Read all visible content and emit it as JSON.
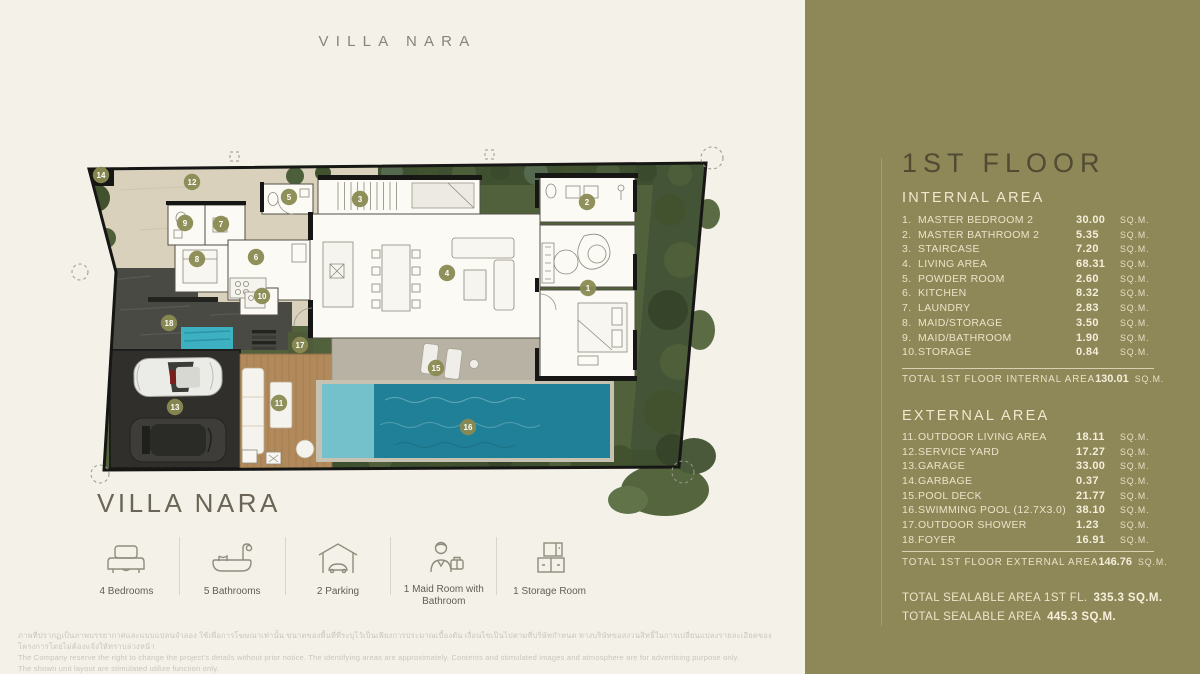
{
  "page": {
    "background": "#f4f1e8",
    "top_title": "VILLA NARA",
    "plan_title": "VILLA NARA"
  },
  "sidebar": {
    "background": "#8e8758",
    "floor_title": "1ST FLOOR",
    "internal": {
      "heading": "INTERNAL AREA",
      "rows": [
        {
          "num": "1.",
          "label": "MASTER BEDROOM 2",
          "value": "30.00",
          "unit": "SQ.M."
        },
        {
          "num": "2.",
          "label": "MASTER BATHROOM 2",
          "value": "5.35",
          "unit": "SQ.M."
        },
        {
          "num": "3.",
          "label": "STAIRCASE",
          "value": "7.20",
          "unit": "SQ.M."
        },
        {
          "num": "4.",
          "label": "LIVING AREA",
          "value": "68.31",
          "unit": "SQ.M."
        },
        {
          "num": "5.",
          "label": "POWDER ROOM",
          "value": "2.60",
          "unit": "SQ.M."
        },
        {
          "num": "6.",
          "label": "KITCHEN",
          "value": "8.32",
          "unit": "SQ.M."
        },
        {
          "num": "7.",
          "label": "LAUNDRY",
          "value": "2.83",
          "unit": "SQ.M."
        },
        {
          "num": "8.",
          "label": "MAID/STORAGE",
          "value": "3.50",
          "unit": "SQ.M."
        },
        {
          "num": "9.",
          "label": "MAID/BATHROOM",
          "value": "1.90",
          "unit": "SQ.M."
        },
        {
          "num": "10.",
          "label": "STORAGE",
          "value": "0.84",
          "unit": "SQ.M."
        }
      ],
      "total_label": "TOTAL 1ST FLOOR INTERNAL AREA",
      "total_value": "130.01",
      "total_unit": "SQ.M."
    },
    "external": {
      "heading": "EXTERNAL AREA",
      "rows": [
        {
          "num": "11.",
          "label": "OUTDOOR LIVING AREA",
          "value": "18.11",
          "unit": "SQ.M."
        },
        {
          "num": "12.",
          "label": "SERVICE YARD",
          "value": "17.27",
          "unit": "SQ.M."
        },
        {
          "num": "13.",
          "label": "GARAGE",
          "value": "33.00",
          "unit": "SQ.M."
        },
        {
          "num": "14.",
          "label": "GARBAGE",
          "value": "0.37",
          "unit": "SQ.M."
        },
        {
          "num": "15.",
          "label": "POOL DECK",
          "value": "21.77",
          "unit": "SQ.M."
        },
        {
          "num": "16.",
          "label": "SWIMMING POOL (12.7X3.0)",
          "value": "38.10",
          "unit": "SQ.M."
        },
        {
          "num": "17.",
          "label": "OUTDOOR SHOWER",
          "value": "1.23",
          "unit": "SQ.M."
        },
        {
          "num": "18.",
          "label": "FOYER",
          "value": "16.91",
          "unit": "SQ.M."
        }
      ],
      "total_label": "TOTAL 1ST FLOOR EXTERNAL AREA",
      "total_value": "146.76",
      "total_unit": "SQ.M."
    },
    "sealable": [
      {
        "label": "TOTAL SEALABLE AREA 1ST FL.",
        "value": "335.3 SQ.M."
      },
      {
        "label": "TOTAL SEALABLE AREA",
        "value": "445.3 SQ.M."
      }
    ]
  },
  "features": [
    {
      "icon": "bed-icon",
      "label": "4 Bedrooms"
    },
    {
      "icon": "bath-icon",
      "label": "5 Bathrooms"
    },
    {
      "icon": "parking-icon",
      "label": "2 Parking"
    },
    {
      "icon": "maid-icon",
      "label": "1 Maid Room with Bathroom"
    },
    {
      "icon": "storage-icon",
      "label": "1 Storage Room"
    }
  ],
  "plan": {
    "marker_color": "#8a8a52",
    "marker_text_color": "#ffffff",
    "pool_color": "#208097",
    "markers": [
      {
        "n": "1",
        "x": 508,
        "y": 138
      },
      {
        "n": "2",
        "x": 507,
        "y": 52
      },
      {
        "n": "3",
        "x": 280,
        "y": 49
      },
      {
        "n": "4",
        "x": 367,
        "y": 123
      },
      {
        "n": "5",
        "x": 209,
        "y": 47
      },
      {
        "n": "6",
        "x": 176,
        "y": 107
      },
      {
        "n": "7",
        "x": 141,
        "y": 74
      },
      {
        "n": "8",
        "x": 117,
        "y": 109
      },
      {
        "n": "9",
        "x": 105,
        "y": 73
      },
      {
        "n": "10",
        "x": 182,
        "y": 146
      },
      {
        "n": "11",
        "x": 199,
        "y": 253
      },
      {
        "n": "12",
        "x": 112,
        "y": 32
      },
      {
        "n": "13",
        "x": 95,
        "y": 257
      },
      {
        "n": "14",
        "x": 21,
        "y": 25
      },
      {
        "n": "15",
        "x": 356,
        "y": 218
      },
      {
        "n": "16",
        "x": 388,
        "y": 277
      },
      {
        "n": "17",
        "x": 220,
        "y": 195
      },
      {
        "n": "18",
        "x": 89,
        "y": 173
      }
    ]
  },
  "disclaimer": {
    "line1": "ภาพที่ปรากฏเป็นภาพบรรยากาศและแบบแปลนจำลอง ใช้เพื่อการโฆษณาเท่านั้น ขนาดของพื้นที่ที่ระบุไว้เป็นเพียงการประมาณเบื้องต้น เงื่อนไขเป็นไปตามที่บริษัทกำหนด ทางบริษัทขอสงวนสิทธิ์ในการเปลี่ยนแปลงรายละเอียดของโครงการโดยไม่ต้องแจ้งให้ทราบล่วงหน้า",
    "line2": "The Company reserve the right to change the project's details without prior notice. The identifying areas are approximately. Contents and stimulated images and atmosphere are for advertising purpose only.",
    "line3": "The shown unit layout are stimulated utilize function only."
  }
}
